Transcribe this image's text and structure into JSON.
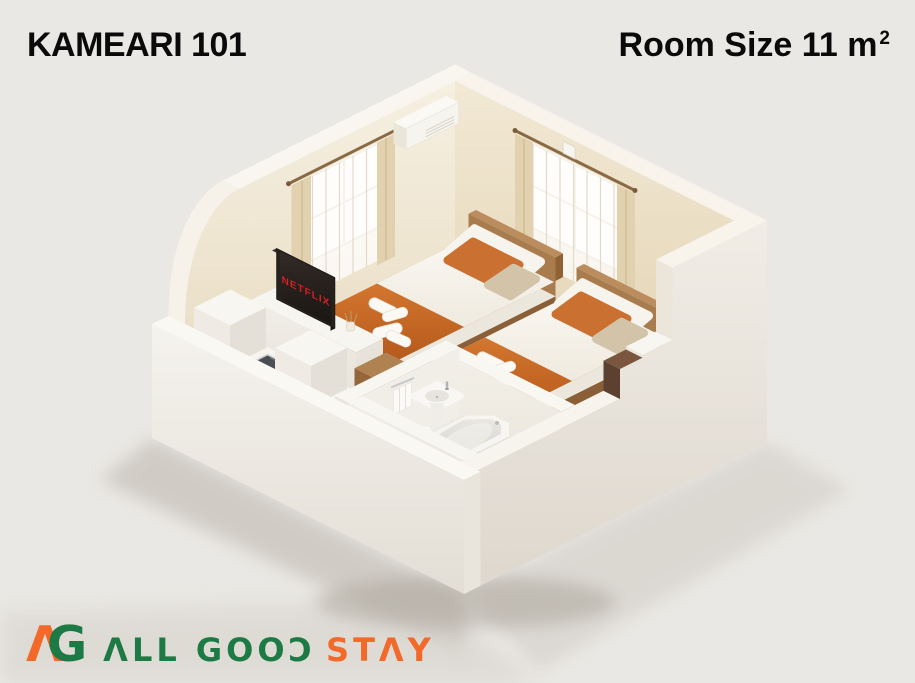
{
  "image_type": "isometric-floor-plan-render",
  "header": {
    "title": "KAMEARI 101",
    "room_size": "Room Size 11 m²",
    "room_size_label": "Room Size 11",
    "room_size_unit": "m",
    "room_size_superscript": "2"
  },
  "room": {
    "tv_label": "NETFLIX",
    "objects": [
      "air-conditioner",
      "window-left",
      "window-right",
      "twin-bed-1",
      "twin-bed-2",
      "orange-bed-runner",
      "pillows",
      "folded-towels",
      "tv-netflix",
      "tv-stand",
      "reed-diffuser",
      "kitchen-counter",
      "kitchen-sink",
      "refrigerator-cube",
      "appliance-cube",
      "bathroom",
      "bathtub",
      "wash-basin",
      "toilet",
      "hand-towel",
      "entrance-door",
      "curved-wall",
      "wood-flooring"
    ]
  },
  "footer": {
    "brand_name": "ALL GOOD STAY",
    "monogram": {
      "a": "Λ",
      "g": "G"
    },
    "wordmark": {
      "part1_text": "ALL GOOD",
      "part1_display": "ΛLL GOOƆ",
      "part2_text": "STAY",
      "part2_display": "STΛY"
    }
  },
  "colors": {
    "background": "#eae8e4",
    "accent_orange": "#f2692a",
    "brand_green": "#1d7a45",
    "bed_orange": "#c66a28",
    "wood": "#a6763f",
    "netflix_red": "#d81f26",
    "text": "#0a0a0a"
  }
}
